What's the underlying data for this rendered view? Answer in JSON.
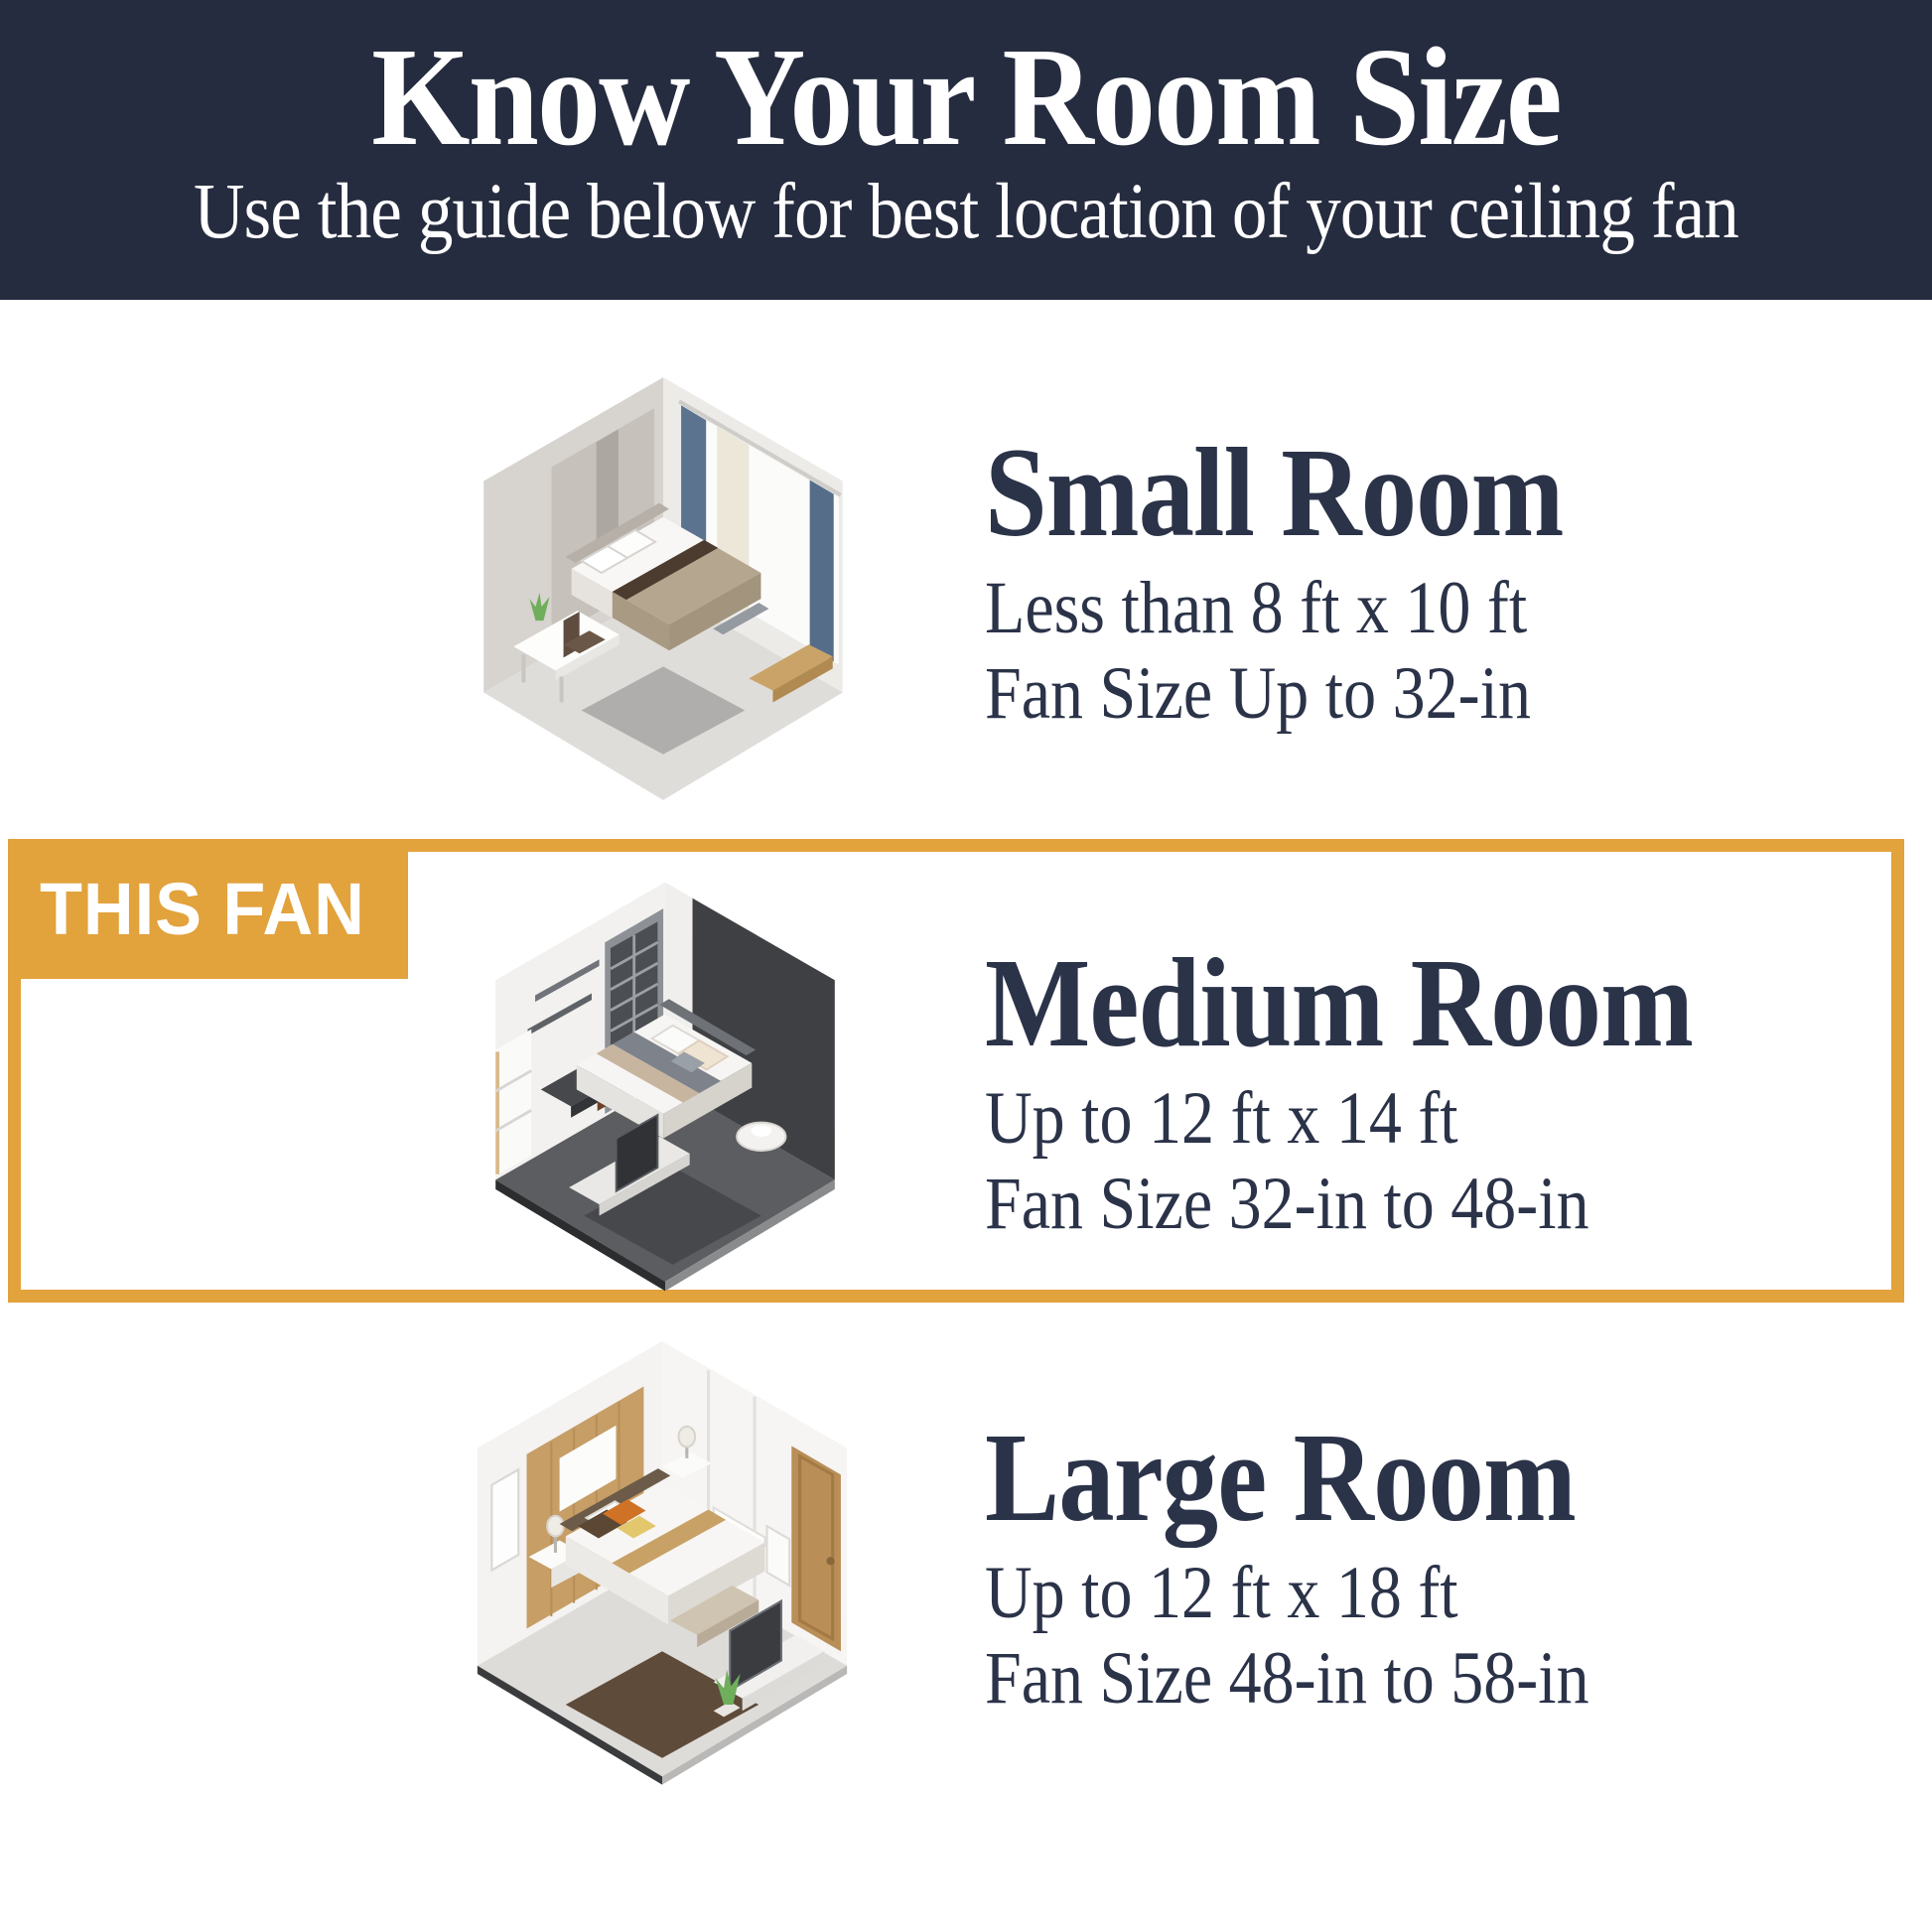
{
  "colors": {
    "accent": "#e2a23c",
    "header_bg": "#262c3f",
    "heading_text": "#2b3349",
    "body_text": "#2b3349",
    "page_bg": "#ffffff",
    "badge_text": "#ffffff"
  },
  "header": {
    "title": "Know Your Room Size",
    "subtitle": "Use the guide below for best location of your ceiling fan"
  },
  "badge": {
    "label": "THIS FAN"
  },
  "sections": [
    {
      "id": "small-room",
      "title": "Small Room",
      "dimensions": "Less than 8 ft x 10 ft",
      "fan_size": "Fan Size Up to 32-in",
      "highlighted": false,
      "illustration": "isometric-small-bedroom"
    },
    {
      "id": "medium-room",
      "title": "Medium Room",
      "dimensions": "Up to 12 ft x 14 ft",
      "fan_size": "Fan Size 32-in to 48-in",
      "highlighted": true,
      "illustration": "isometric-medium-bedroom"
    },
    {
      "id": "large-room",
      "title": "Large Room",
      "dimensions": "Up to 12 ft x 18 ft",
      "fan_size": "Fan Size 48-in to 58-in",
      "highlighted": false,
      "illustration": "isometric-large-bedroom"
    }
  ]
}
